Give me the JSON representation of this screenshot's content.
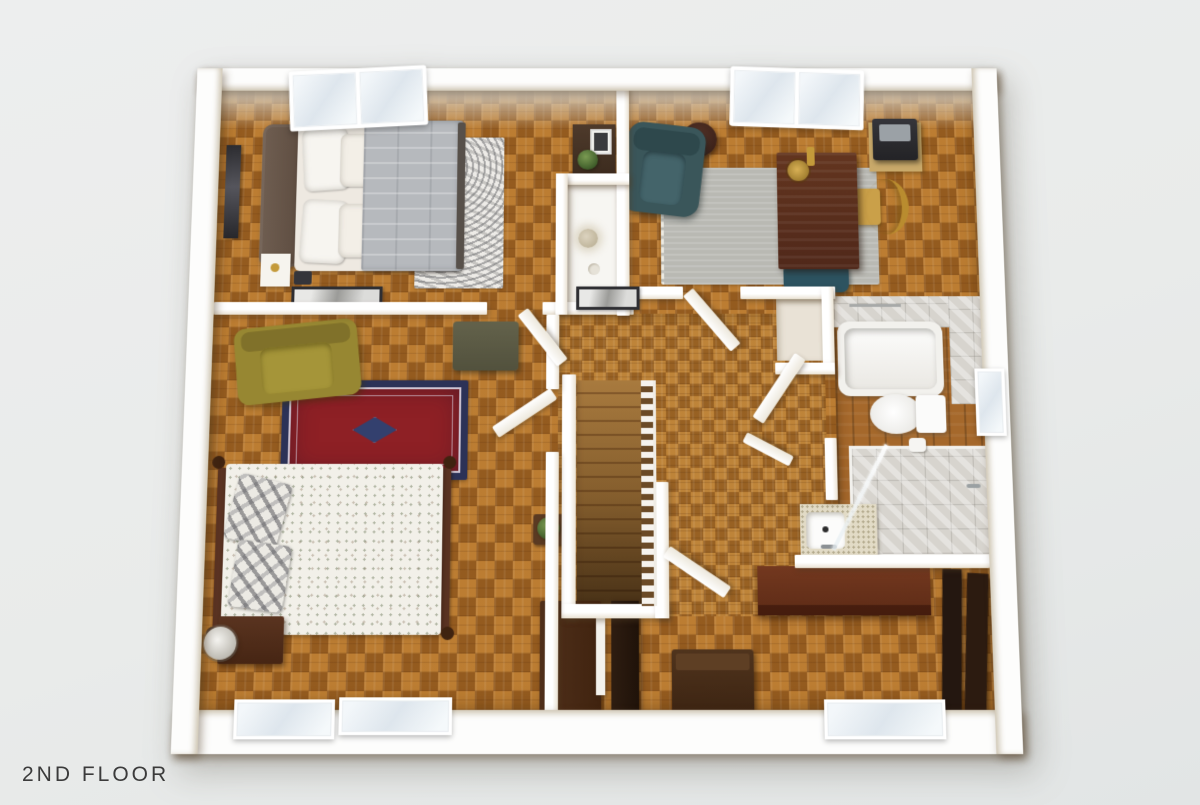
{
  "title": {
    "label": "2ND FLOOR"
  },
  "scene": {
    "type": "floor-plan-3d-render",
    "floor": "2nd",
    "rooms": [
      "bedroom-upper-left",
      "home-office-upper-right",
      "closet-nook",
      "linen-closet",
      "bedroom-lower-left",
      "hallway-with-staircase",
      "bathroom-right",
      "lower-right-room"
    ]
  },
  "palette": {
    "background": "#e9ebea",
    "walls": "#ffffff",
    "wall_face_beige": "#eae2d3",
    "floor_parquet": "#b0742e",
    "floor_hall": "#b37c34",
    "floor_bath_wood": "#a5682b",
    "tile_gray": "#d7d4ce",
    "accent_teal": "#3a565a",
    "accent_olive": "#978732",
    "rug_red": "#8e2025",
    "rug_navy_border": "#2c3257",
    "rug_gray": "#b9b9b3",
    "rug_distressed_white": "#edebe7",
    "duvet_gray": "#b6b9bd",
    "wood_mahogany": "#6e3520",
    "wood_walnut_dark": "#3a2414",
    "brass": "#c49a3a",
    "title_text": "#3b3b3b"
  },
  "furniture": {
    "bedroom_upper_left": [
      "double-bed-gray-duvet",
      "upholstered-headboard",
      "white-pillows",
      "distressed-gray-rug",
      "wall-art-frame",
      "white-nightstand",
      "dark-accessory",
      "wood-shelf-with-plant-and-print",
      "skylight-window"
    ],
    "home_office_upper_right": [
      "teal-recliner",
      "round-side-table",
      "gray-area-rug-with-fringe",
      "mahogany-desk",
      "brass-desk-lamp",
      "teal-desk-chair",
      "rattan-fan-chair",
      "printer-on-corner-shelf",
      "skylight-window"
    ],
    "closet_nook": [
      "white-counter",
      "pampas-vase",
      "trinket-dish"
    ],
    "bedroom_lower_left": [
      "four-poster-bed-floral-duvet",
      "plaid-pillows",
      "olive-armchair",
      "olive-bench",
      "red-oriental-rug",
      "dark-nightstand",
      "table-lamp",
      "wall-art-frame",
      "plant-on-wall-shelf",
      "window",
      "window"
    ],
    "hallway": [
      "staircase-down",
      "stair-railing",
      "picture-frame-on-wall",
      "potted-plant",
      "leaning-door-panel"
    ],
    "bathroom": [
      "bathtub",
      "towel-bar",
      "toilet",
      "toilet-paper-holder",
      "walk-in-glass-shower",
      "shower-head",
      "vanity-counter",
      "sink-basin",
      "faucet",
      "window"
    ],
    "lower_right_room": [
      "small-dresser",
      "tall-bookshelf",
      "storage-chest",
      "long-mahogany-dresser",
      "tall-cabinet",
      "tall-cabinet",
      "window"
    ]
  }
}
